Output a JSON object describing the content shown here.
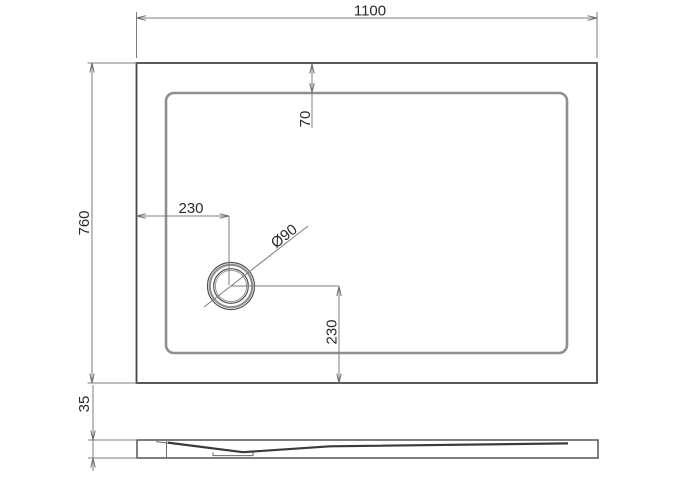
{
  "drawing": {
    "top_view": {
      "width_dim": "1100",
      "depth_dim": "760",
      "rim_inset_dim": "70",
      "drain_offset_x_dim": "230",
      "drain_offset_y_dim": "230",
      "drain_diameter_label": "Ø90"
    },
    "side_view": {
      "height_dim": "35"
    },
    "colors": {
      "background": "#ffffff",
      "outline": "#474747",
      "inner_edge": "#8f8f8f",
      "dimension_lines": "#7d7d7d",
      "text": "#2a2a2a"
    }
  }
}
